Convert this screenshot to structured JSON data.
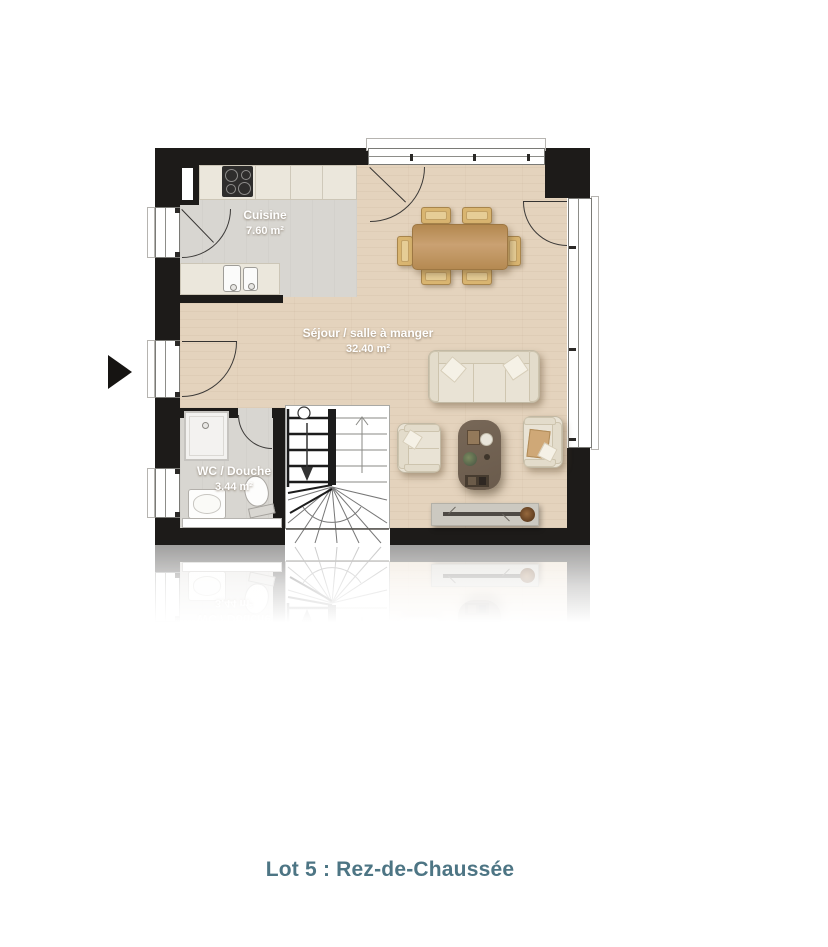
{
  "plan": {
    "rooms": {
      "cuisine": {
        "name": "Cuisine",
        "area": "7.60 m²"
      },
      "sejour": {
        "name": "Séjour / salle à manger",
        "area": "32.40 m²"
      },
      "wc": {
        "name": "WC / Douche",
        "area": "3.44 m²"
      }
    }
  },
  "caption": "Lot 5 : Rez-de-Chaussée",
  "colors": {
    "wall": "#1d1b19",
    "wood_floor": "#e4d3bd",
    "tile_floor": "#d8d6d1",
    "counter": "#ebe7dc",
    "table_wood": "#bf9561",
    "chair": "#d9b570",
    "sofa": "#e9e3d5",
    "coffee_table": "#6f6050",
    "tv_stand": "#ccc9c1",
    "label_text": "#ffffff",
    "caption_text": "#4d7584"
  }
}
